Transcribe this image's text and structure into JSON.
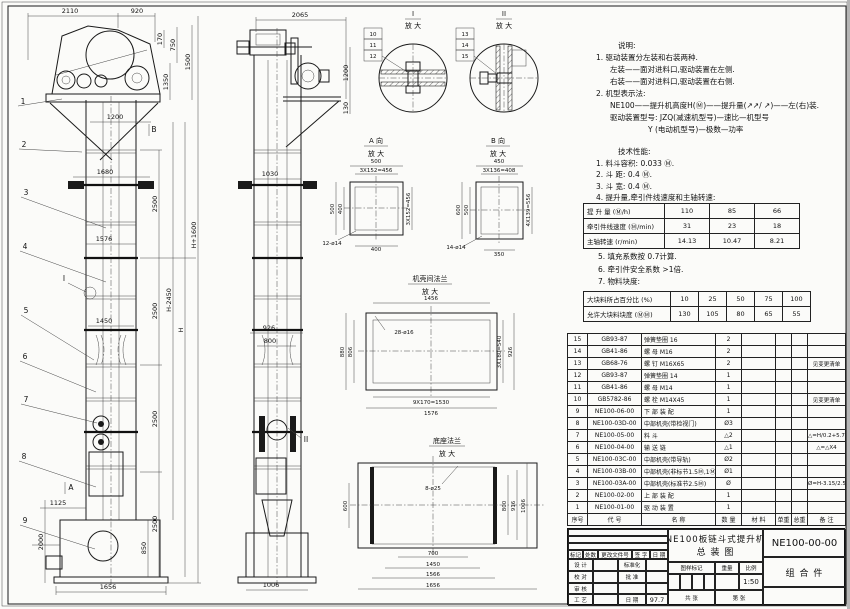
{
  "front": {
    "dim_2110": "2110",
    "dim_920": "920",
    "dim_170": "170",
    "dim_750": "750",
    "dim_1350": "1350",
    "dim_1500": "1500",
    "dim_1200": "1200",
    "dim_1680": "1680",
    "dim_1576": "1576",
    "dim_1450": "1450",
    "seg1": "2500",
    "seg2": "2500",
    "seg3": "2500",
    "seg4": "2500",
    "dim_850": "850",
    "dim_h2450": "H-2450",
    "dim_h": "H",
    "dim_h1600": "H+1600",
    "dim_1125": "1125",
    "dim_2000": "2000",
    "dim_1656": "1656",
    "marker_a": "A",
    "marker_b": "B",
    "marker_i": "I",
    "balloons": [
      "1",
      "2",
      "3",
      "4",
      "5",
      "6",
      "7",
      "8",
      "9"
    ]
  },
  "side": {
    "dim_2065": "2065",
    "dim_1200": "1200",
    "dim_130": "130",
    "dim_1030": "1030",
    "dim_926": "926",
    "dim_800": "800",
    "dim_1006": "1006",
    "marker_ii": "II"
  },
  "detail_i": {
    "title": "I",
    "subtitle": "放 大",
    "balloons": [
      "10",
      "11",
      "12"
    ]
  },
  "detail_ii": {
    "title": "II",
    "subtitle": "放 大",
    "balloons": [
      "13",
      "14",
      "15"
    ]
  },
  "view_a": {
    "title": "A 向",
    "subtitle": "放 大",
    "dim_top": "500",
    "dim_top2": "3X152=456",
    "dim_left": "500",
    "dim_left2": "400",
    "dim_right": "3X152=456",
    "dim_bottom": "400",
    "holes": "12-ø14"
  },
  "view_b": {
    "title": "B 向",
    "subtitle": "放 大",
    "dim_top": "450",
    "dim_top2": "3X136=408",
    "dim_left": "600",
    "dim_left2": "500",
    "dim_right": "4X139=556",
    "dim_bottom": "350",
    "holes": "14-ø14"
  },
  "flange_mid": {
    "title": "机壳间法兰",
    "subtitle": "放 大",
    "dim_top": "1456",
    "holes": "28-ø16",
    "dim_left": "880",
    "dim_left2": "806",
    "dim_right": "3X180=540",
    "dim_right2": "926",
    "dim_bottom": "9X170=1530",
    "dim_bottom2": "1576"
  },
  "flange_base": {
    "title": "底座法兰",
    "subtitle": "放 大",
    "holes": "8-ø25",
    "dim_left": "600",
    "dim_right": "800",
    "dim_right2": "916",
    "dim_right3": "1006",
    "dim_bottom": "700",
    "dim_bottom2": "1450",
    "dim_bottom3": "1566",
    "dim_bottom4": "1656"
  },
  "notes": {
    "title": "说明:",
    "lines": [
      "1. 驱动装置分左装和右装两种.",
      "左装——面对进料口,驱动装置在左侧.",
      "右装——面对进料口,驱动装置在右侧.",
      "2. 机型表示法:",
      "NE100——提升机高度H(Ⓜ)——提升量(↗↗/ ↗)——左(右)装.",
      "驱动装置型号: JZQ(减速机型号)—速比—机型号",
      "Y (电动机型号)—极数—功率"
    ]
  },
  "specs": {
    "title": "技术性能:",
    "items_top": [
      "1. 料斗容积: 0.033 Ⓜ.",
      "2. 斗  距: 0.4 Ⓜ.",
      "3. 斗  宽: 0.4 Ⓜ.",
      "4. 提升量,牵引件线速度和主轴转速:"
    ],
    "table1": {
      "rows": [
        {
          "label": "提 升 量  (Ⓜ/h)",
          "v1": "110",
          "v2": "85",
          "v3": "66"
        },
        {
          "label": "牵引件线速度 (Ⓜ/min)",
          "v1": "31",
          "v2": "23",
          "v3": "18"
        },
        {
          "label": "主轴转速 (r/min)",
          "v1": "14.13",
          "v2": "10.47",
          "v3": "8.21"
        }
      ]
    },
    "items_bottom": [
      "5. 填充系数按 0.7计算.",
      "6. 牵引件安全系数 >1倍.",
      "7. 物料块度:"
    ],
    "table2": {
      "rows": [
        {
          "label": "大块料所占百分比  (%)",
          "v1": "10",
          "v2": "25",
          "v3": "50",
          "v4": "75",
          "v5": "100"
        },
        {
          "label": "允许大块料块度  (ⓂⓂ)",
          "v1": "130",
          "v2": "105",
          "v3": "80",
          "v4": "65",
          "v5": "55"
        }
      ]
    }
  },
  "bom": {
    "headers": [
      "序号",
      "代  号",
      "名  称",
      "数 量",
      "材  料",
      "单重",
      "总重",
      "备  注"
    ],
    "rows": [
      {
        "no": "15",
        "code": "GB93-87",
        "name": "弹簧垫圈 16",
        "qty": "2",
        "material": "",
        "unit": "",
        "total": "",
        "remark": ""
      },
      {
        "no": "14",
        "code": "GB41-86",
        "name": "螺 母 M16",
        "qty": "2",
        "material": "",
        "unit": "",
        "total": "",
        "remark": ""
      },
      {
        "no": "13",
        "code": "GB68-76",
        "name": "螺 钉 M16X65",
        "qty": "2",
        "material": "",
        "unit": "",
        "total": "",
        "remark": "见变更清单"
      },
      {
        "no": "12",
        "code": "GB93-87",
        "name": "弹簧垫圈 14",
        "qty": "1",
        "material": "",
        "unit": "",
        "total": "",
        "remark": ""
      },
      {
        "no": "11",
        "code": "GB41-86",
        "name": "螺 母 M14",
        "qty": "1",
        "material": "",
        "unit": "",
        "total": "",
        "remark": ""
      },
      {
        "no": "10",
        "code": "GB5782-86",
        "name": "螺 栓 M14X45",
        "qty": "1",
        "material": "",
        "unit": "",
        "total": "",
        "remark": "见变更清单"
      },
      {
        "no": "9",
        "code": "NE100-06-00",
        "name": "下 部 装 配",
        "qty": "1",
        "material": "",
        "unit": "",
        "total": "",
        "remark": ""
      },
      {
        "no": "8",
        "code": "NE100-03D-00",
        "name": "中部机壳(带检视门)",
        "qty": "Ø3",
        "material": "",
        "unit": "",
        "total": "",
        "remark": ""
      },
      {
        "no": "7",
        "code": "NE100-05-00",
        "name": "料 斗",
        "qty": "△2",
        "material": "",
        "unit": "",
        "total": "",
        "remark": "△=H/0.2+5.75"
      },
      {
        "no": "6",
        "code": "NE100-04-00",
        "name": "输 送 链",
        "qty": "△1",
        "material": "",
        "unit": "",
        "total": "",
        "remark": "△=△X4"
      },
      {
        "no": "5",
        "code": "NE100-03C-00",
        "name": "中部机壳(带导轨)",
        "qty": "Ø2",
        "material": "",
        "unit": "",
        "total": "",
        "remark": ""
      },
      {
        "no": "4",
        "code": "NE100-03B-00",
        "name": "中部机壳(非标节1.5Ⓜ,1Ⓜ)",
        "qty": "Ø1",
        "material": "",
        "unit": "",
        "total": "",
        "remark": ""
      },
      {
        "no": "3",
        "code": "NE100-03A-00",
        "name": "中部机壳(标准节2.5Ⓜ)",
        "qty": "Ø",
        "material": "",
        "unit": "",
        "total": "",
        "remark": "Ø=H-3.15/2.5"
      },
      {
        "no": "2",
        "code": "NE100-02-00",
        "name": "上 部 装 配",
        "qty": "1",
        "material": "",
        "unit": "",
        "total": "",
        "remark": ""
      },
      {
        "no": "1",
        "code": "NE100-01-00",
        "name": "驱 动 装 置",
        "qty": "1",
        "material": "",
        "unit": "",
        "total": "",
        "remark": ""
      }
    ]
  },
  "titleblock": {
    "name_line1": "NE100板链斗式提升机",
    "name_line2": "总  装  图",
    "drawing_no": "NE100-00-00",
    "part_class": "组 合 件",
    "rev_headers": [
      "标记",
      "处数",
      "更改文件号",
      "签 字",
      "日 期"
    ],
    "sign_r1c1": "设 计",
    "sign_r1c3": "标准化",
    "sign_r2c1": "校 对",
    "sign_r2c3": "批 准",
    "sign_r3c1": "审 核",
    "sign_r3c3": "",
    "sign_r4c1": "工 艺",
    "sign_r4c3": "日 期",
    "date": "97.7",
    "mark_headers": [
      "图样标记",
      "重量",
      "比例"
    ],
    "scale": "1:50",
    "sheet_total": "共    张",
    "sheet_no": "第    张"
  }
}
